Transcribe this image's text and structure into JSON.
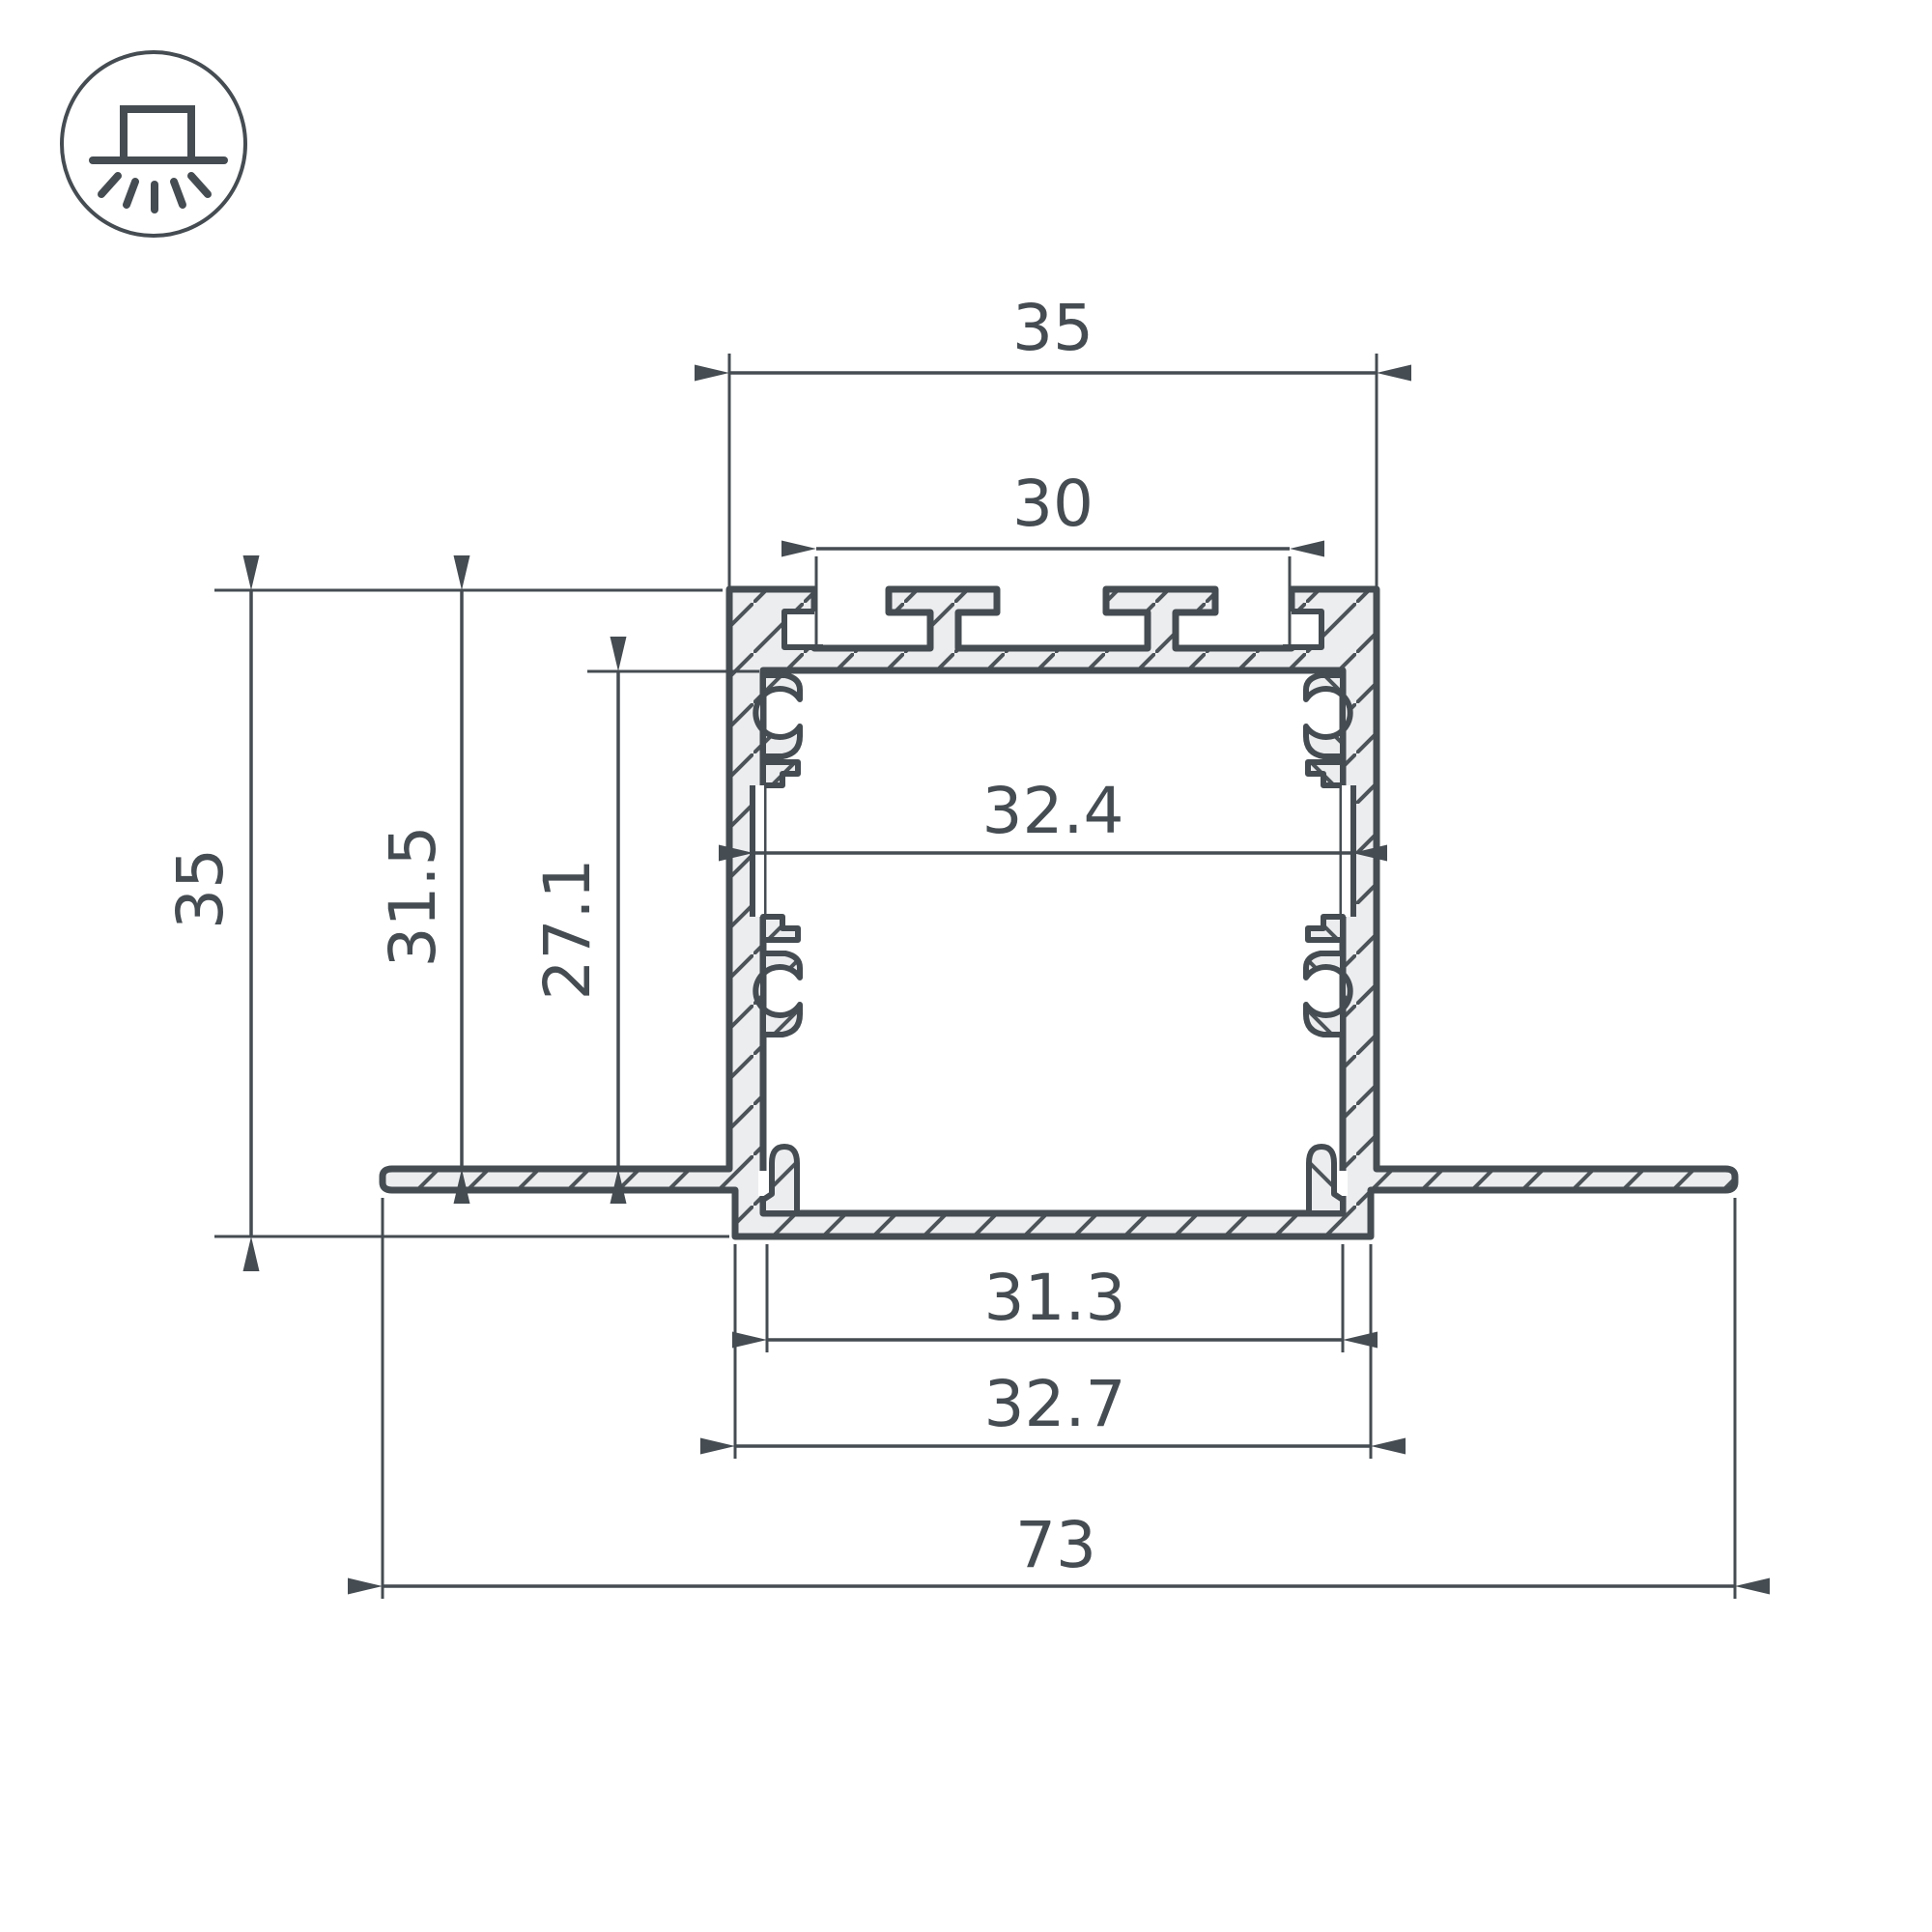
{
  "page": {
    "background": "#ffffff",
    "description": "Technical cross-section drawing of a recessed (trimless) aluminum LED profile with dimension callouts"
  },
  "style": {
    "line_color": "#454c52",
    "material_fill": "#ecedef",
    "hatch_color": "#4d5459"
  },
  "units": "mm",
  "icon": {
    "name": "recessed-mount-icon",
    "meaning": "recessed ceiling mount luminaire symbol"
  },
  "dimensions": {
    "top_width": "35",
    "top_slot_width": "30",
    "inner_width": "32.4",
    "overall_height": "35",
    "recess_depth": "31.5",
    "inner_depth": "27.1",
    "bottom_opening_inner": "31.3",
    "bottom_opening_outer": "32.7",
    "overall_width": "73"
  }
}
